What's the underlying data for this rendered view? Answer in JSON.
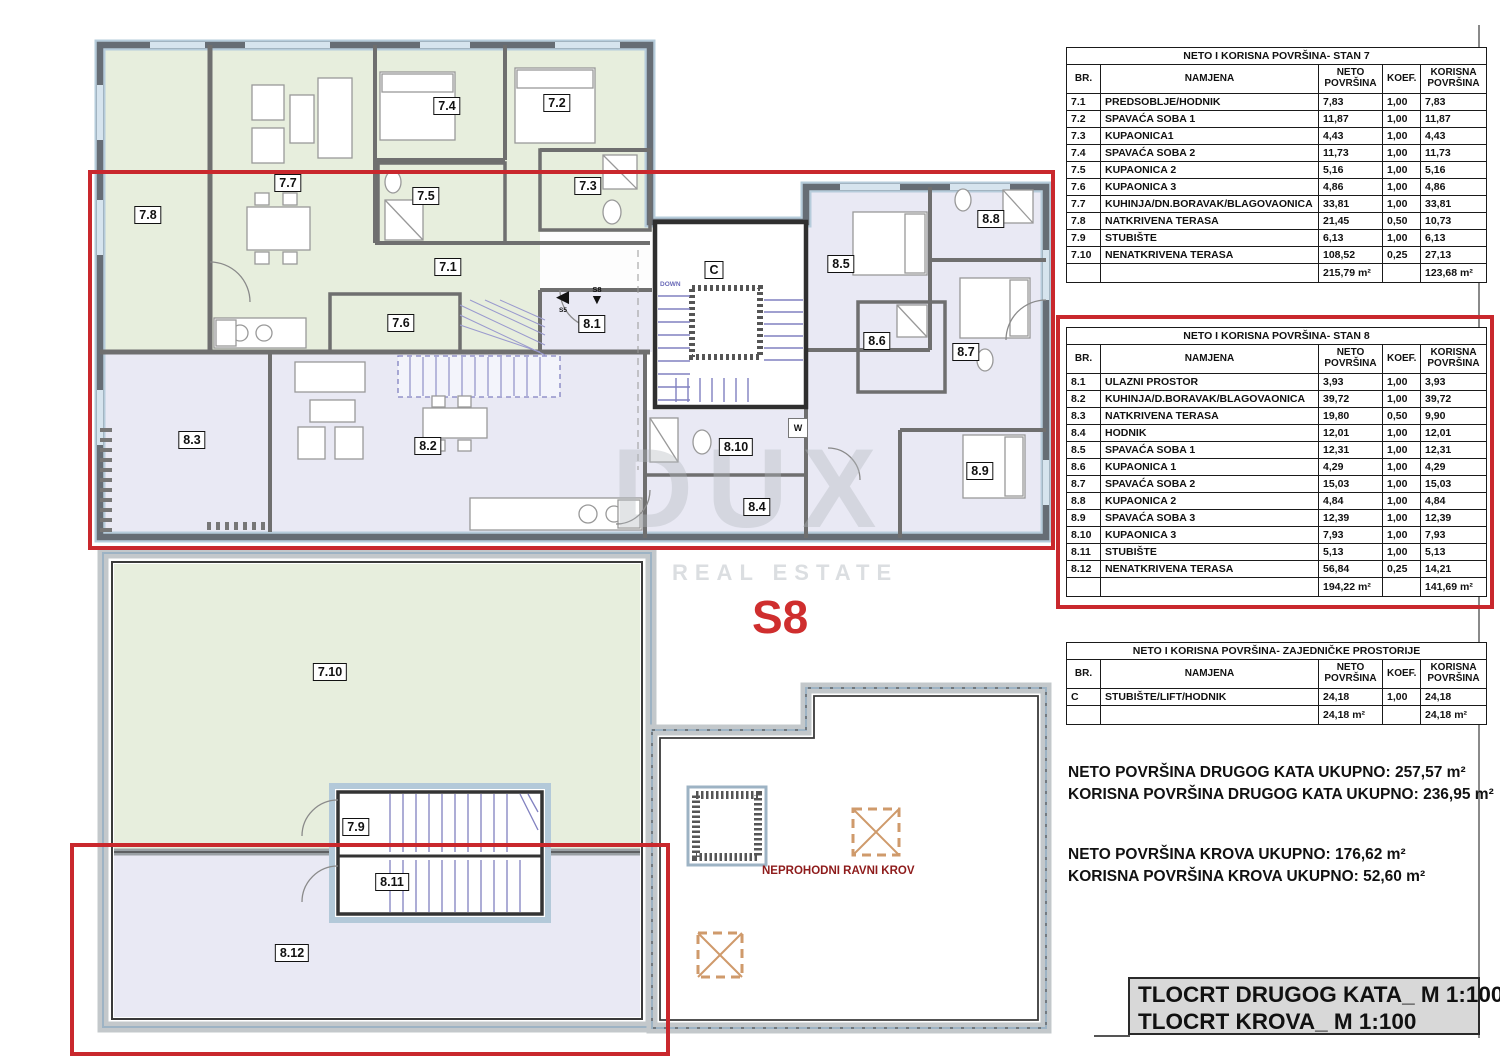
{
  "colors": {
    "stan7_fill": "#e7eedd",
    "stan8_fill": "#e9e9f4",
    "wall": "#666d75",
    "highlight_red": "#c9282d",
    "stairs_blue": "#8181c0",
    "roof_note_red": "#8e1b1b",
    "titleblock_bg": "#d8d8d8"
  },
  "watermark": {
    "line1": "DUX",
    "line2": "REAL ESTATE"
  },
  "unit_marker": "S8",
  "plan": {
    "labels": [
      "7.4",
      "7.2",
      "7.8",
      "7.7",
      "7.5",
      "7.3",
      "7.1",
      "7.6",
      "8.8",
      "8.5",
      "8.6",
      "8.7",
      "8.1",
      "8.10",
      "8.9",
      "8.3",
      "8.2",
      "8.4",
      "7.10",
      "7.9",
      "8.11",
      "8.12",
      "C"
    ],
    "roof_note": "NEPROHODNI RAVNI KROV",
    "down_label": "DOWN",
    "washer_label": "W",
    "entrance_arrows": {
      "left_label": "S5",
      "down_label": "S8"
    }
  },
  "tables": {
    "stan7": {
      "title": "NETO I KORISNA POVRŠINA- STAN 7",
      "columns": [
        "BR.",
        "NAMJENA",
        "NETO POVRŠINA",
        "KOEF.",
        "KORISNA POVRŠINA"
      ],
      "rows": [
        [
          "7.1",
          "PREDSOBLJE/HODNIK",
          "7,83",
          "1,00",
          "7,83"
        ],
        [
          "7.2",
          "SPAVAĆA SOBA 1",
          "11,87",
          "1,00",
          "11,87"
        ],
        [
          "7.3",
          "KUPAONICA1",
          "4,43",
          "1,00",
          "4,43"
        ],
        [
          "7.4",
          "SPAVAĆA SOBA 2",
          "11,73",
          "1,00",
          "11,73"
        ],
        [
          "7.5",
          "KUPAONICA 2",
          "5,16",
          "1,00",
          "5,16"
        ],
        [
          "7.6",
          "KUPAONICA 3",
          "4,86",
          "1,00",
          "4,86"
        ],
        [
          "7.7",
          "KUHINJA/DN.BORAVAK/BLAGOVAONICA",
          "33,81",
          "1,00",
          "33,81"
        ],
        [
          "7.8",
          "NATKRIVENA TERASA",
          "21,45",
          "0,50",
          "10,73"
        ],
        [
          "7.9",
          "STUBIŠTE",
          "6,13",
          "1,00",
          "6,13"
        ],
        [
          "7.10",
          "NENATKRIVENA TERASA",
          "108,52",
          "0,25",
          "27,13"
        ]
      ],
      "total": [
        "",
        "",
        "215,79 m²",
        "",
        "123,68 m²"
      ]
    },
    "stan8": {
      "title": "NETO I KORISNA POVRŠINA- STAN 8",
      "columns": [
        "BR.",
        "NAMJENA",
        "NETO POVRŠINA",
        "KOEF.",
        "KORISNA POVRŠINA"
      ],
      "rows": [
        [
          "8.1",
          "ULAZNI PROSTOR",
          "3,93",
          "1,00",
          "3,93"
        ],
        [
          "8.2",
          "KUHINJA/D.BORAVAK/BLAGOVAONICA",
          "39,72",
          "1,00",
          "39,72"
        ],
        [
          "8.3",
          "NATKRIVENA TERASA",
          "19,80",
          "0,50",
          "9,90"
        ],
        [
          "8.4",
          "HODNIK",
          "12,01",
          "1,00",
          "12,01"
        ],
        [
          "8.5",
          "SPAVAĆA SOBA 1",
          "12,31",
          "1,00",
          "12,31"
        ],
        [
          "8.6",
          "KUPAONICA 1",
          "4,29",
          "1,00",
          "4,29"
        ],
        [
          "8.7",
          "SPAVAĆA SOBA 2",
          "15,03",
          "1,00",
          "15,03"
        ],
        [
          "8.8",
          "KUPAONICA 2",
          "4,84",
          "1,00",
          "4,84"
        ],
        [
          "8.9",
          "SPAVAĆA SOBA 3",
          "12,39",
          "1,00",
          "12,39"
        ],
        [
          "8.10",
          "KUPAONICA 3",
          "7,93",
          "1,00",
          "7,93"
        ],
        [
          "8.11",
          "STUBIŠTE",
          "5,13",
          "1,00",
          "5,13"
        ],
        [
          "8.12",
          "NENATKRIVENA TERASA",
          "56,84",
          "0,25",
          "14,21"
        ]
      ],
      "total": [
        "",
        "",
        "194,22 m²",
        "",
        "141,69 m²"
      ]
    },
    "common": {
      "title": "NETO I KORISNA POVRŠINA- ZAJEDNIČKE PROSTORIJE",
      "columns": [
        "BR.",
        "NAMJENA",
        "NETO POVRŠINA",
        "KOEF.",
        "KORISNA POVRŠINA"
      ],
      "rows": [
        [
          "C",
          "STUBIŠTE/LIFT/HODNIK",
          "24,18",
          "1,00",
          "24,18"
        ]
      ],
      "total": [
        "",
        "",
        "24,18 m²",
        "",
        "24,18 m²"
      ]
    }
  },
  "summary": {
    "lines": [
      "NETO POVRŠINA DRUGOG KATA UKUPNO: 257,57 m²",
      "KORISNA POVRŠINA DRUGOG KATA UKUPNO: 236,95 m²",
      "NETO POVRŠINA KROVA UKUPNO: 176,62 m²",
      "KORISNA POVRŠINA KROVA UKUPNO: 52,60 m²"
    ]
  },
  "title_block": {
    "line1": "TLOCRT DRUGOG KATA_ M 1:100",
    "line2": "TLOCRT KROVA_ M 1:100"
  }
}
